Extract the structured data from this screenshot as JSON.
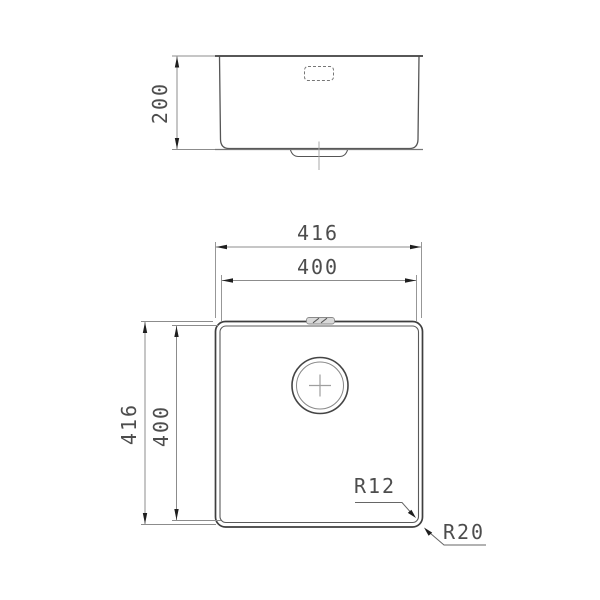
{
  "drawing": {
    "type": "sink-technical-drawing",
    "background": "#ffffff",
    "colors": {
      "outline": "#3f3f3f",
      "secondary": "#5a5a5a",
      "dimension_line": "#8c8c8c",
      "arrow": "#1f1f1f",
      "text": "#4d4d4d",
      "centerline": "#a8a8a8",
      "hatch_fill": "#d9d9d9"
    },
    "views": {
      "side_view": "sink front elevation with overflow window and drain stub",
      "plan_view": "sink top view with drain hole, overflow slot and corner radii"
    },
    "dimensions": {
      "side_depth": "200",
      "plan_width_outer": "416",
      "plan_width_inner": "400",
      "plan_height_outer": "416",
      "plan_height_inner": "400",
      "radius_inner": "R12",
      "radius_outer": "R20"
    }
  }
}
